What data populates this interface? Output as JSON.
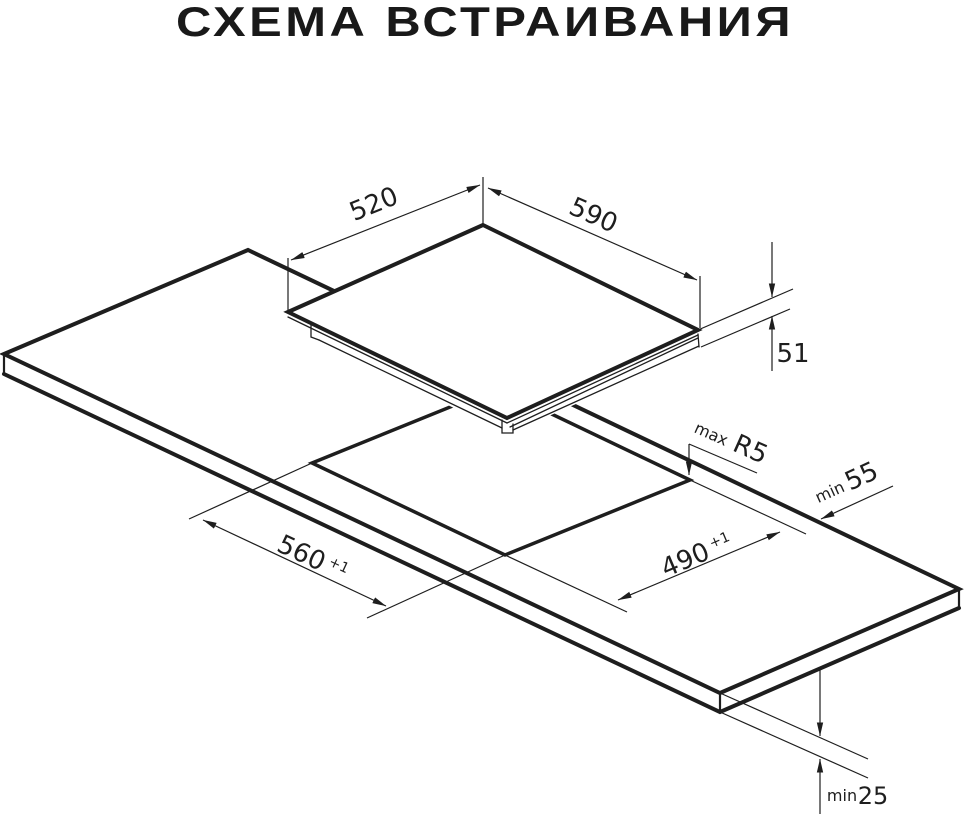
{
  "title": "СХЕМА ВСТРАИВАНИЯ",
  "colors": {
    "line": "#1e1e1e",
    "background": "#ffffff"
  },
  "diagram": {
    "type": "isometric-installation-drawing",
    "parts": [
      "hob",
      "worktop",
      "cutout"
    ]
  },
  "dimensions": {
    "hob_depth": {
      "value": "520"
    },
    "hob_width": {
      "value": "590"
    },
    "hob_height": {
      "value": "51"
    },
    "corner_radius": {
      "prefix": "max",
      "value": "R5"
    },
    "rear_clearance": {
      "prefix": "min",
      "value": "55"
    },
    "cutout_width": {
      "value": "560",
      "tolerance": "+1"
    },
    "cutout_depth": {
      "value": "490",
      "tolerance": "+1"
    },
    "worktop_thickness": {
      "prefix": "min",
      "value": "25"
    }
  }
}
